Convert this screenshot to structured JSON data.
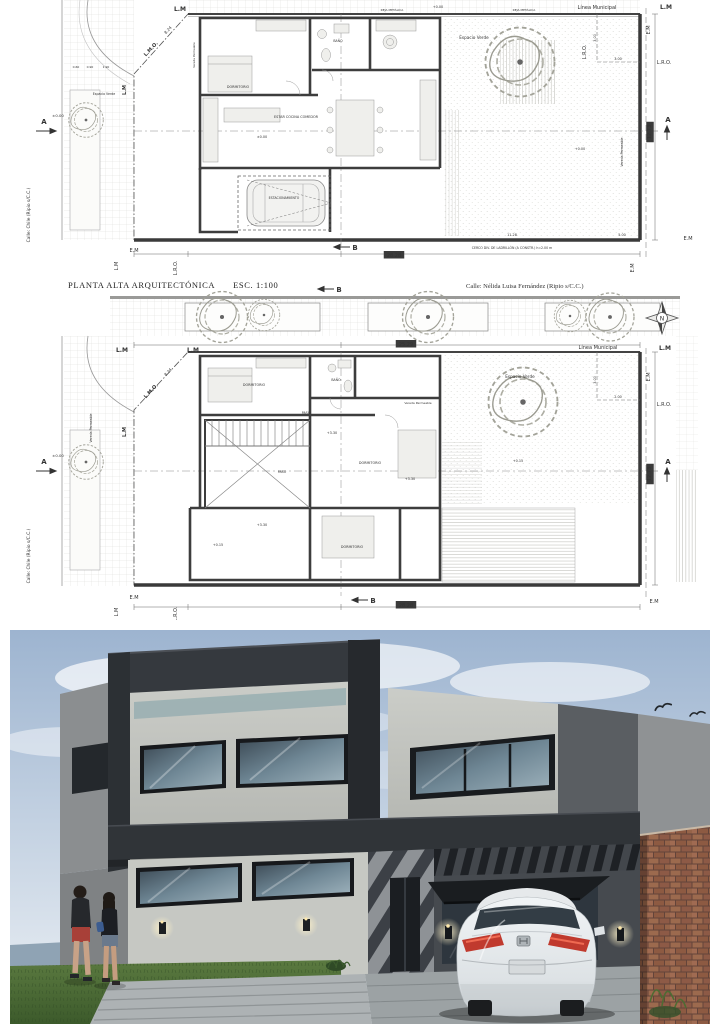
{
  "title_block": {
    "plan_title": "PLANTA ALTA ARQUITECTÓNICA",
    "scale": "ESC. 1:100",
    "street_top": "Calle: Nélida Luisa Fernández (Ripio s/C.C.)"
  },
  "compass": {
    "letter": "N"
  },
  "plan_upper": {
    "annotations": [
      {
        "t": "L.M",
        "x": 180,
        "y": 11,
        "s": 6,
        "w": 1,
        "n": "lm-label"
      },
      {
        "t": "Línea Municipal",
        "x": 597,
        "y": 9,
        "s": 5,
        "n": "linea-municipal-label"
      },
      {
        "t": "L.M",
        "x": 666,
        "y": 9,
        "s": 6,
        "w": 1,
        "n": "lm-label"
      },
      {
        "t": "E.M",
        "x": 650,
        "y": 30,
        "s": 5,
        "r": -90,
        "n": "em-label"
      },
      {
        "t": "L.R.O.",
        "x": 586,
        "y": 52,
        "s": 5,
        "r": -90,
        "n": "lro-label"
      },
      {
        "t": "L.R.O.",
        "x": 664,
        "y": 64,
        "s": 5,
        "n": "lro-label"
      },
      {
        "t": "3.00",
        "x": 596,
        "y": 38,
        "s": 3.4,
        "r": -90,
        "n": "dim-label"
      },
      {
        "t": "3.00",
        "x": 618,
        "y": 60,
        "s": 3.4,
        "n": "dim-label"
      },
      {
        "t": "12.73",
        "x": 651,
        "y": 132,
        "s": 5,
        "r": -90,
        "box": 1,
        "n": "dim-label"
      },
      {
        "t": "A",
        "x": 668,
        "y": 122,
        "s": 7,
        "w": 1,
        "n": "section-marker-a"
      },
      {
        "t": "A",
        "x": 44,
        "y": 124,
        "s": 7,
        "w": 1,
        "n": "section-marker-a"
      },
      {
        "t": "±0.00",
        "x": 58,
        "y": 117,
        "s": 3.8,
        "n": "level-label"
      },
      {
        "t": "L.M.O.",
        "x": 152,
        "y": 50,
        "s": 5,
        "w": 1,
        "r": -47,
        "n": "lmo-label"
      },
      {
        "t": "8.24",
        "x": 169,
        "y": 31,
        "s": 4,
        "r": -47,
        "n": "dim-label"
      },
      {
        "t": "L.M",
        "x": 126,
        "y": 90,
        "s": 5,
        "w": 1,
        "r": -90,
        "n": "lm-label"
      },
      {
        "t": "0.60",
        "x": 76,
        "y": 68,
        "s": 3,
        "n": "dim-label"
      },
      {
        "t": "0.90",
        "x": 90,
        "y": 68,
        "s": 3,
        "n": "dim-label"
      },
      {
        "t": "1.90",
        "x": 106,
        "y": 68,
        "s": 3,
        "n": "dim-label"
      },
      {
        "t": "Espacio Verde",
        "x": 104,
        "y": 95,
        "s": 3.2,
        "n": "area-label"
      },
      {
        "t": "Espacio Verde",
        "x": 474,
        "y": 39,
        "s": 4.2,
        "n": "area-label"
      },
      {
        "t": "REJA METÁLICA",
        "x": 392,
        "y": 11,
        "s": 3,
        "n": "fence-label"
      },
      {
        "t": "REJA METÁLICA",
        "x": 524,
        "y": 11,
        "s": 3,
        "n": "fence-label"
      },
      {
        "t": "+0.00",
        "x": 438,
        "y": 8,
        "s": 3.4,
        "n": "level-label"
      },
      {
        "t": "+0.00",
        "x": 580,
        "y": 150,
        "s": 3.4,
        "n": "level-label"
      },
      {
        "t": "DORMITORIO",
        "x": 238,
        "y": 88,
        "s": 3.4,
        "n": "room-label"
      },
      {
        "t": "BAÑO",
        "x": 338,
        "y": 42,
        "s": 3.2,
        "n": "room-label"
      },
      {
        "t": "ESTAR COCINA COMEDOR",
        "x": 296,
        "y": 118,
        "s": 3.4,
        "n": "room-label"
      },
      {
        "t": "±0.00",
        "x": 262,
        "y": 138,
        "s": 3.4,
        "n": "level-label"
      },
      {
        "t": "ESTACIONAMIENTO",
        "x": 284,
        "y": 199,
        "s": 3.2,
        "n": "room-label"
      },
      {
        "t": "Vereda Permeable",
        "x": 623,
        "y": 152,
        "s": 3.2,
        "r": -90,
        "n": "area-label"
      },
      {
        "t": "Vereda Permeable",
        "x": 195,
        "y": 55,
        "s": 2.8,
        "r": -90,
        "n": "area-label"
      },
      {
        "t": "Calle: Chile (Ripio s/C.C.)",
        "x": 30,
        "y": 215,
        "s": 4.4,
        "r": -90,
        "n": "street-label"
      },
      {
        "t": "E.M",
        "x": 134,
        "y": 252,
        "s": 5,
        "n": "em-label"
      },
      {
        "t": "L.M",
        "x": 118,
        "y": 266,
        "s": 5,
        "r": -90,
        "n": "lm-label"
      },
      {
        "t": "L.R.O.",
        "x": 177,
        "y": 268,
        "s": 5,
        "r": -90,
        "n": "lro-label"
      },
      {
        "t": "B",
        "x": 355,
        "y": 250,
        "s": 7,
        "w": 1,
        "n": "section-marker-b"
      },
      {
        "t": "28.28",
        "x": 394,
        "y": 257,
        "s": 5,
        "box": 1,
        "n": "dim-label"
      },
      {
        "t": "11.28",
        "x": 512,
        "y": 236,
        "s": 3.4,
        "n": "dim-label"
      },
      {
        "t": "5.00",
        "x": 622,
        "y": 236,
        "s": 3.4,
        "n": "dim-label"
      },
      {
        "t": "CERCO DIV. DE LADRILLÓN (A CONSTR.) h=2.00 m",
        "x": 512,
        "y": 249,
        "s": 3.2,
        "n": "fence-note"
      },
      {
        "t": "E.M",
        "x": 688,
        "y": 240,
        "s": 5,
        "n": "em-label"
      },
      {
        "t": "E.M",
        "x": 634,
        "y": 268,
        "s": 5,
        "r": -90,
        "n": "em-label"
      }
    ]
  },
  "plan_lower": {
    "annotations": [
      {
        "t": "B",
        "x": 339,
        "y": 292,
        "s": 7,
        "w": 1,
        "n": "section-marker-b"
      },
      {
        "t": "25.29",
        "x": 406,
        "y": 346,
        "s": 5,
        "box": 1,
        "n": "dim-label"
      },
      {
        "t": "L.M",
        "x": 193,
        "y": 352,
        "s": 6,
        "w": 1,
        "n": "lm-label"
      },
      {
        "t": "L.M",
        "x": 122,
        "y": 352,
        "s": 6,
        "w": 1,
        "n": "lm-label"
      },
      {
        "t": "Línea Municipal",
        "x": 598,
        "y": 349,
        "s": 5,
        "n": "linea-municipal-label"
      },
      {
        "t": "L.M",
        "x": 665,
        "y": 350,
        "s": 6,
        "w": 1,
        "n": "lm-label"
      },
      {
        "t": "E.M",
        "x": 650,
        "y": 377,
        "s": 5,
        "r": -90,
        "n": "em-label"
      },
      {
        "t": "L.R.O.",
        "x": 664,
        "y": 406,
        "s": 5,
        "n": "lro-label"
      },
      {
        "t": "3.00",
        "x": 596,
        "y": 380,
        "s": 3.4,
        "r": -90,
        "n": "dim-label"
      },
      {
        "t": "2.00",
        "x": 618,
        "y": 398,
        "s": 3.4,
        "n": "dim-label"
      },
      {
        "t": "12.73",
        "x": 651,
        "y": 474,
        "s": 5,
        "r": -90,
        "box": 1,
        "n": "dim-label"
      },
      {
        "t": "A",
        "x": 668,
        "y": 464,
        "s": 7,
        "w": 1,
        "n": "section-marker-a"
      },
      {
        "t": "A",
        "x": 44,
        "y": 464,
        "s": 7,
        "w": 1,
        "n": "section-marker-a"
      },
      {
        "t": "±0.00",
        "x": 58,
        "y": 457,
        "s": 3.8,
        "n": "level-label"
      },
      {
        "t": "L.M.O.",
        "x": 152,
        "y": 392,
        "s": 5,
        "w": 1,
        "r": -47,
        "n": "lmo-label"
      },
      {
        "t": "8.24",
        "x": 169,
        "y": 373,
        "s": 4,
        "r": -47,
        "n": "dim-label"
      },
      {
        "t": "L.M",
        "x": 126,
        "y": 432,
        "s": 5,
        "w": 1,
        "r": -90,
        "n": "lm-label"
      },
      {
        "t": "DORMITORIO",
        "x": 254,
        "y": 386,
        "s": 3.4,
        "n": "room-label"
      },
      {
        "t": "BAÑO",
        "x": 336,
        "y": 381,
        "s": 3.2,
        "n": "room-label"
      },
      {
        "t": "PASO",
        "x": 306,
        "y": 414,
        "s": 3.2,
        "n": "room-label"
      },
      {
        "t": "PASO",
        "x": 282,
        "y": 473,
        "s": 3.2,
        "n": "room-label"
      },
      {
        "t": "DORMITORIO",
        "x": 370,
        "y": 464,
        "s": 3.4,
        "n": "room-label"
      },
      {
        "t": "DORMITORIO",
        "x": 352,
        "y": 548,
        "s": 3.4,
        "n": "room-label"
      },
      {
        "t": "+3.30",
        "x": 332,
        "y": 434,
        "s": 3.4,
        "n": "level-label"
      },
      {
        "t": "+3.30",
        "x": 410,
        "y": 480,
        "s": 3.4,
        "n": "level-label"
      },
      {
        "t": "+3.30",
        "x": 262,
        "y": 526,
        "s": 3.4,
        "n": "level-label"
      },
      {
        "t": "+0.15",
        "x": 218,
        "y": 546,
        "s": 3.4,
        "n": "level-label"
      },
      {
        "t": "+0.15",
        "x": 518,
        "y": 462,
        "s": 3.4,
        "n": "level-label"
      },
      {
        "t": "Vereda Permeable",
        "x": 92,
        "y": 428,
        "s": 3.2,
        "r": -90,
        "n": "area-label"
      },
      {
        "t": "Vereda Permeable",
        "x": 418,
        "y": 404,
        "s": 3,
        "n": "area-label"
      },
      {
        "t": "Espacio Verde",
        "x": 520,
        "y": 378,
        "s": 4.2,
        "n": "area-label"
      },
      {
        "t": "Calle: Chile (Ripio s/C.C.)",
        "x": 30,
        "y": 556,
        "s": 4.4,
        "r": -90,
        "n": "street-label"
      },
      {
        "t": "E.M",
        "x": 134,
        "y": 599,
        "s": 5,
        "n": "em-label"
      },
      {
        "t": "L.M",
        "x": 118,
        "y": 612,
        "s": 5,
        "r": -90,
        "n": "lm-label"
      },
      {
        "t": "L.R.O.",
        "x": 177,
        "y": 614,
        "s": 5,
        "r": -90,
        "n": "lro-label"
      },
      {
        "t": "B",
        "x": 373,
        "y": 603,
        "s": 7,
        "w": 1,
        "n": "section-marker-b"
      },
      {
        "t": "28.28",
        "x": 406,
        "y": 607,
        "s": 5,
        "box": 1,
        "n": "dim-label"
      },
      {
        "t": "E.M",
        "x": 654,
        "y": 603,
        "s": 5,
        "n": "em-label"
      }
    ]
  },
  "render": {
    "palette": {
      "sky": "#9db4d0",
      "charcoal_frame": "#33373c",
      "stucco_wall": "#c4c6c1",
      "concrete_grey": "#8f9294",
      "glass": "#4c5a64",
      "grass": "#4f7038",
      "brick_wall": "#8a573f",
      "car_body": "#e9edef",
      "awning": "#1a1d20"
    }
  }
}
